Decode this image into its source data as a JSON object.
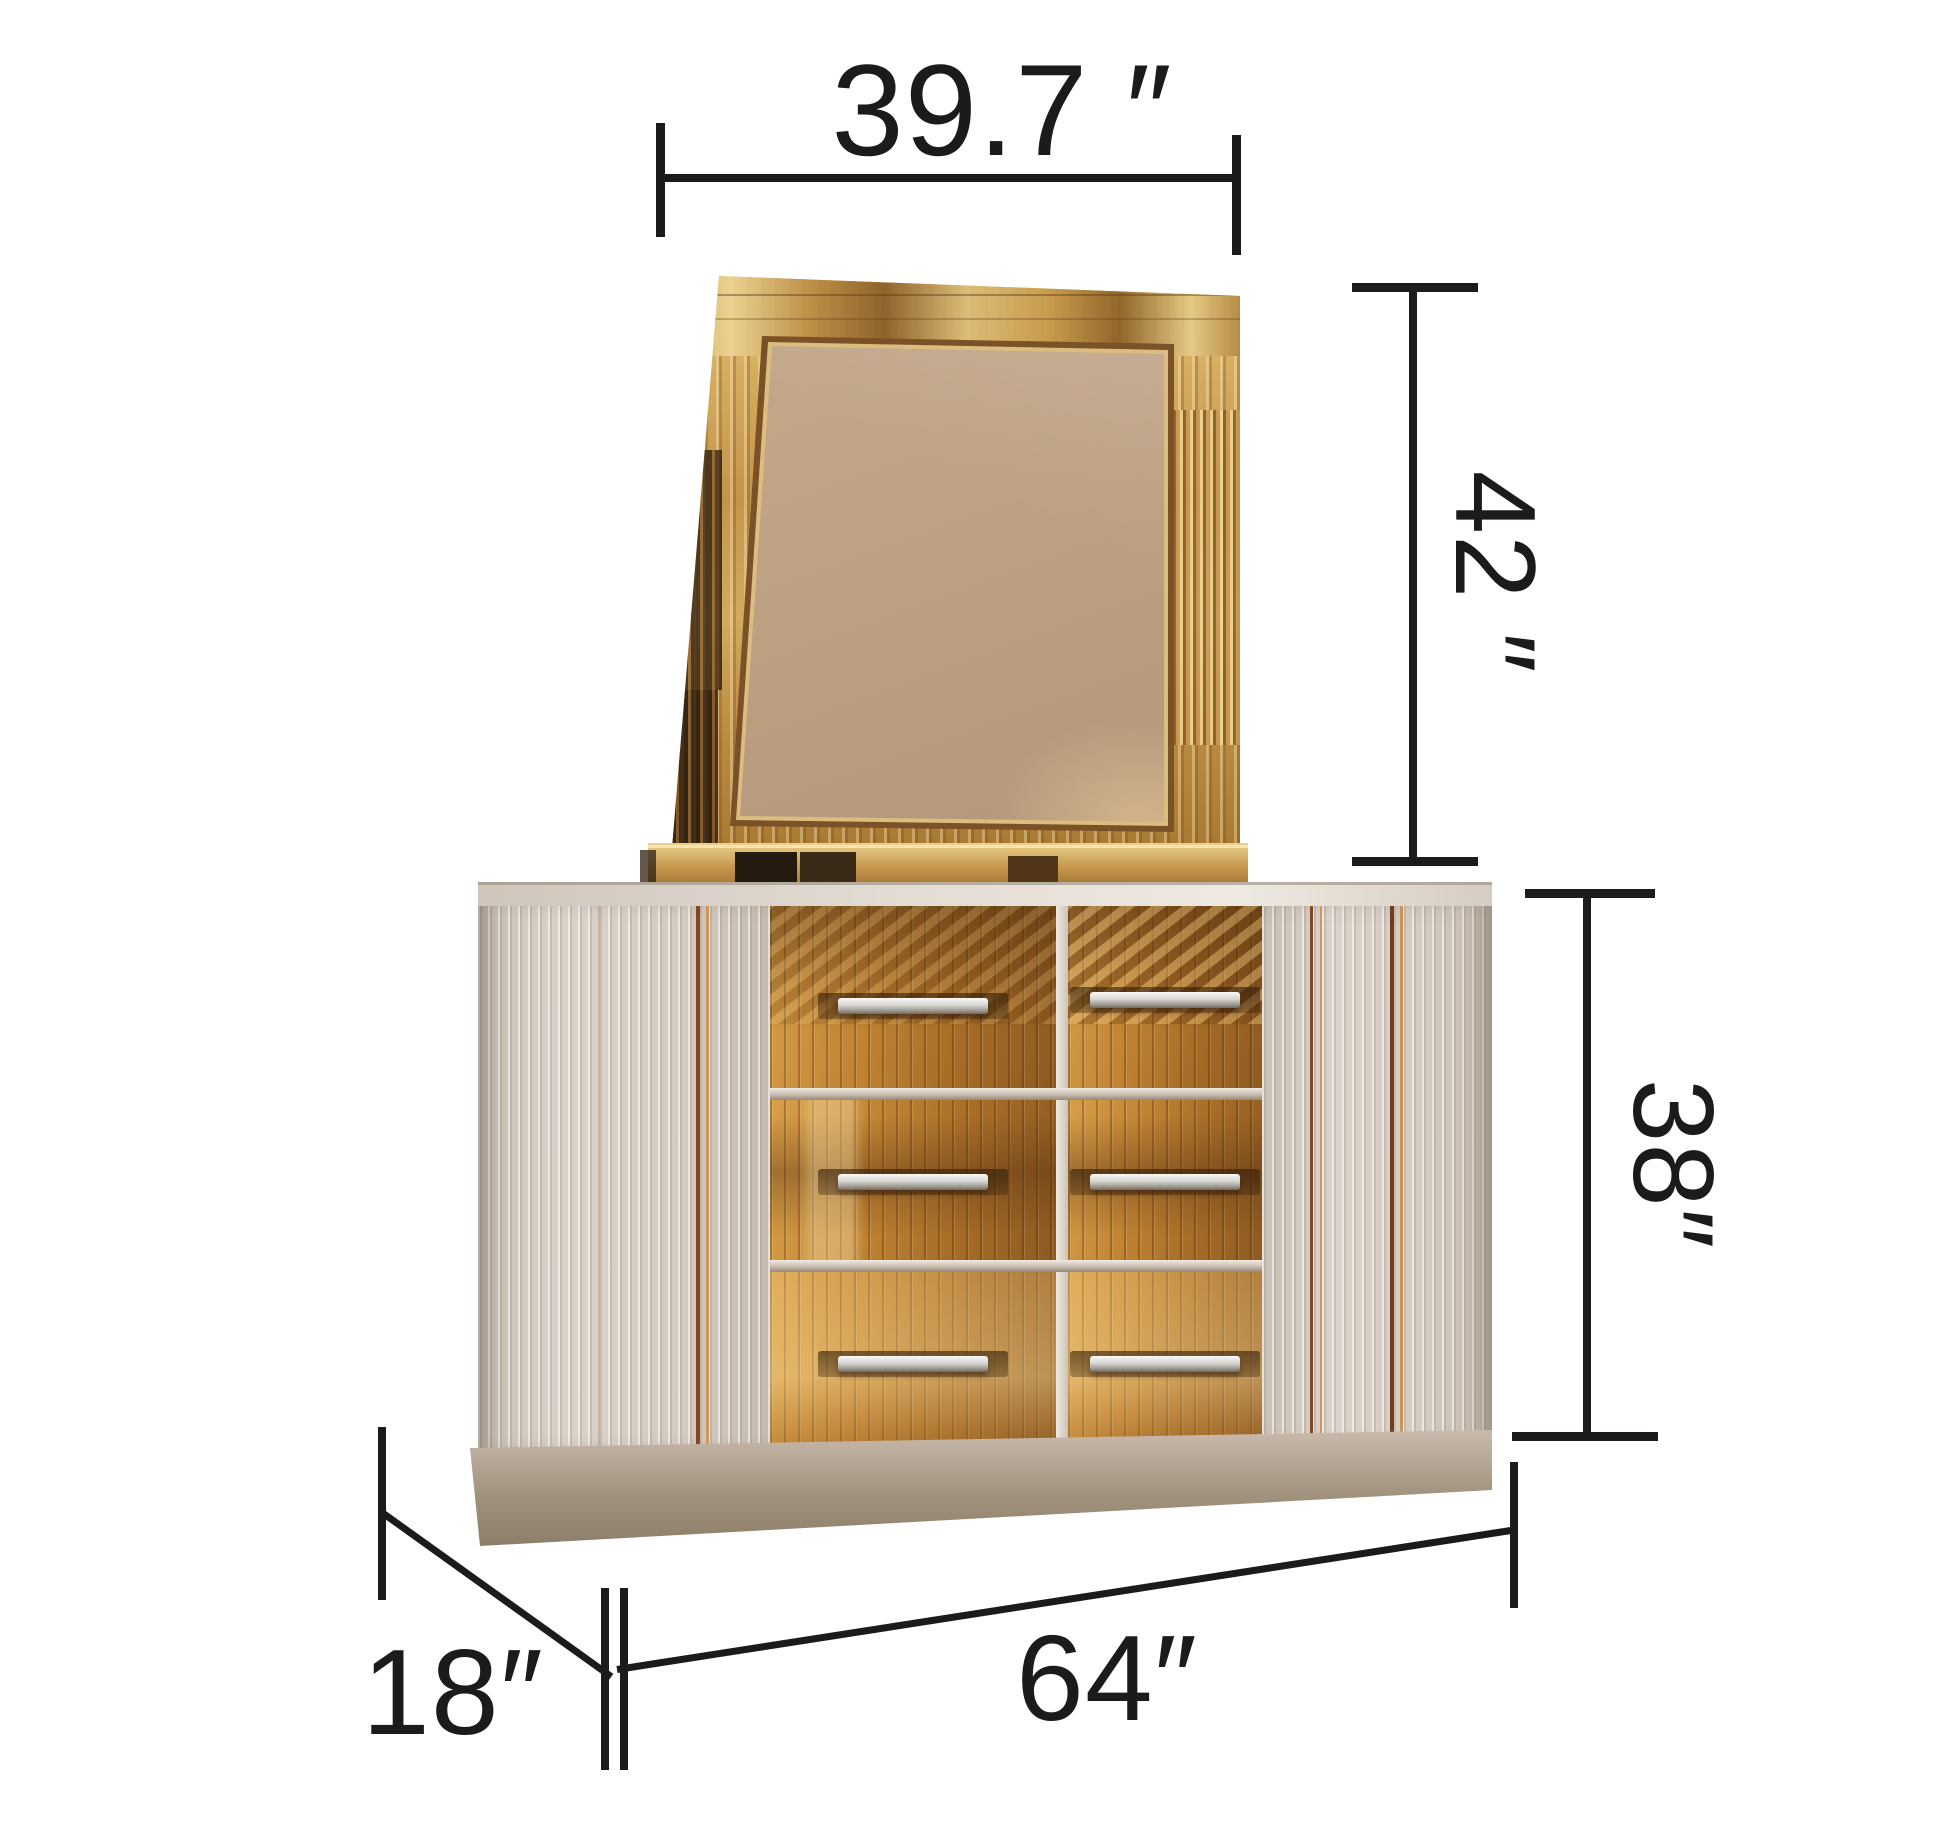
{
  "dimensions": {
    "mirror_width": {
      "label": "39.7 ″"
    },
    "mirror_height": {
      "label": "42 ″"
    },
    "dresser_height": {
      "label": "38″"
    },
    "dresser_depth": {
      "label": "18″"
    },
    "dresser_width": {
      "label": "64″"
    }
  },
  "colors": {
    "background": "#ffffff",
    "annotation": "#1d1a1b",
    "frame_gold": "#c99a4e",
    "glass_tan": "#b89a7e",
    "drawer_gold": "#b27a2e",
    "panel_beige": "#d7cec5",
    "base_taupe": "#a2937f",
    "handle_chrome": "#d8d6d1"
  }
}
